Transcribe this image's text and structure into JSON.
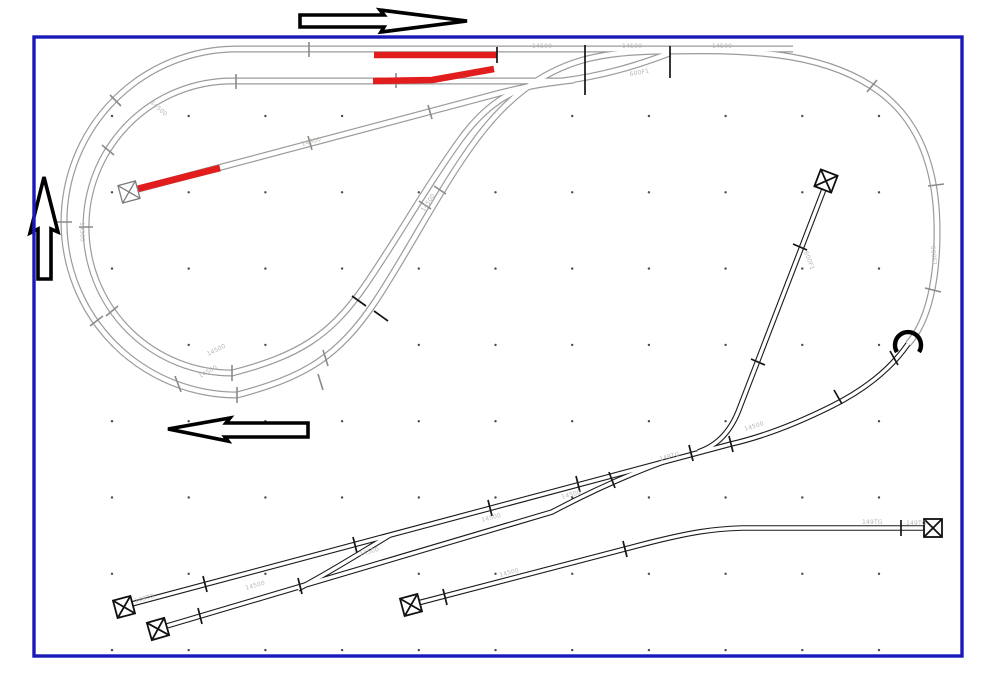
{
  "app": {
    "view": "model-railroad-track-plan",
    "description_visible_text_only": true
  },
  "colors": {
    "border_blue": "#1a1ab8",
    "track_gray": "#9b9b9b",
    "track_dark": "#1a1a1a",
    "highlight_red": "#e11d1d",
    "label_gray": "#b3aea8",
    "grid_dot": "#4a4a4a"
  },
  "grid": {
    "origin_x": 112,
    "origin_y": 116,
    "spacing_x": 76.7,
    "spacing_y": 76.3,
    "cols": 11,
    "rows": 8,
    "dot_radius": 1.2
  },
  "annotations": {
    "arrows": [
      {
        "name": "direction-arrow-right"
      },
      {
        "name": "direction-arrow-up"
      },
      {
        "name": "direction-arrow-left"
      }
    ],
    "highlighted_track_sections": 3,
    "hook_symbol": {
      "x": 908,
      "y": 347
    }
  },
  "track_labels": [
    {
      "text": "14500",
      "x": 532,
      "y": 48,
      "rot": 0
    },
    {
      "text": "14500",
      "x": 622,
      "y": 48,
      "rot": 0
    },
    {
      "text": "14500",
      "x": 712,
      "y": 48,
      "rot": 0
    },
    {
      "text": "600F1",
      "x": 630,
      "y": 76,
      "rot": -10
    },
    {
      "text": "600F1",
      "x": 931,
      "y": 246,
      "rot": 85
    },
    {
      "text": "149TG",
      "x": 906,
      "y": 525,
      "rot": 0
    },
    {
      "text": "14500",
      "x": 150,
      "y": 103,
      "rot": 42
    },
    {
      "text": "14500",
      "x": 80,
      "y": 222,
      "rot": 88
    },
    {
      "text": "14500",
      "x": 200,
      "y": 378,
      "rot": -28
    },
    {
      "text": "14500",
      "x": 208,
      "y": 356,
      "rot": -26
    },
    {
      "text": "14500",
      "x": 424,
      "y": 212,
      "rot": -56
    },
    {
      "text": "14500",
      "x": 302,
      "y": 146,
      "rot": -15
    },
    {
      "text": "14500",
      "x": 360,
      "y": 556,
      "rot": -15
    },
    {
      "text": "14500",
      "x": 482,
      "y": 522,
      "rot": -15
    },
    {
      "text": "14500",
      "x": 562,
      "y": 499,
      "rot": -15
    },
    {
      "text": "149TG",
      "x": 660,
      "y": 461,
      "rot": -15
    },
    {
      "text": "14500",
      "x": 745,
      "y": 431,
      "rot": -17
    },
    {
      "text": "600F1",
      "x": 804,
      "y": 252,
      "rot": 69
    },
    {
      "text": "14500",
      "x": 246,
      "y": 590,
      "rot": -16
    },
    {
      "text": "149TG",
      "x": 135,
      "y": 603,
      "rot": -15
    },
    {
      "text": "14500",
      "x": 500,
      "y": 577,
      "rot": -15
    },
    {
      "text": "149TG",
      "x": 862,
      "y": 524,
      "rot": 0
    }
  ],
  "buffer_stops": [
    {
      "x": 129,
      "y": 192,
      "rot": -15,
      "tone": "gray"
    },
    {
      "x": 826,
      "y": 181,
      "rot": 111,
      "tone": "dark"
    },
    {
      "x": 933,
      "y": 528,
      "rot": 0,
      "tone": "dark"
    },
    {
      "x": 124,
      "y": 607,
      "rot": -15,
      "tone": "dark"
    },
    {
      "x": 158,
      "y": 629,
      "rot": -16,
      "tone": "dark"
    },
    {
      "x": 411,
      "y": 605,
      "rot": -15,
      "tone": "dark"
    }
  ]
}
